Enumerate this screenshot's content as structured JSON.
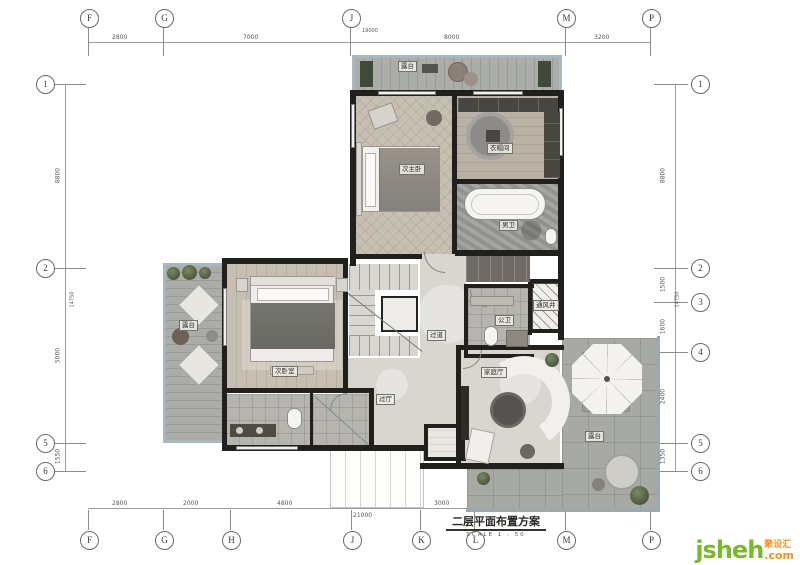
{
  "title": {
    "text": "二层平面布置方案",
    "scale_label": "SCALE",
    "scale_value": "1 : 50"
  },
  "watermark": {
    "brand": "jsheh",
    "tld": ".com",
    "cn": "聚设汇"
  },
  "grid": {
    "top": {
      "letters": [
        "F",
        "G",
        "J",
        "M",
        "P"
      ],
      "dims": [
        "2800",
        "7000",
        "8000",
        "3200"
      ],
      "overall": "19000"
    },
    "bottom": {
      "letters": [
        "F",
        "G",
        "H",
        "J",
        "K",
        "L",
        "M",
        "P"
      ],
      "dims": [
        "2800",
        "2000",
        "4800",
        "2800",
        "3000"
      ],
      "overall": "21000"
    },
    "left": {
      "numbers": [
        "1",
        "2",
        "5",
        "6"
      ],
      "dims": [
        "8800",
        "5000",
        "1550"
      ],
      "overall": "14750"
    },
    "right": {
      "numbers": [
        "1",
        "2",
        "3",
        "4",
        "5",
        "6"
      ],
      "dims": [
        "8800",
        "1500",
        "1600",
        "2400",
        "1350"
      ],
      "overall": "14750"
    }
  },
  "rooms": {
    "terrace_top": "露台",
    "master_bedroom": "次主卧",
    "cloakroom": "衣帽间",
    "master_bath": "男卫",
    "corridor": "过道",
    "public_bath": "公卫",
    "vent_shaft": "通风井",
    "family_hall": "家庭厅",
    "terrace_left": "露台",
    "second_bedroom": "次卧室",
    "hall": "过厅",
    "terrace_bottom": "露台"
  },
  "colors": {
    "wall": "#21201d",
    "wood": "#c6bfb1",
    "deck": "#aaaca8",
    "marble": "#9d9d9b",
    "terrace_edge": "#a9b7c0",
    "logo_green": "#7cb82f",
    "logo_orange": "#f6921e"
  }
}
